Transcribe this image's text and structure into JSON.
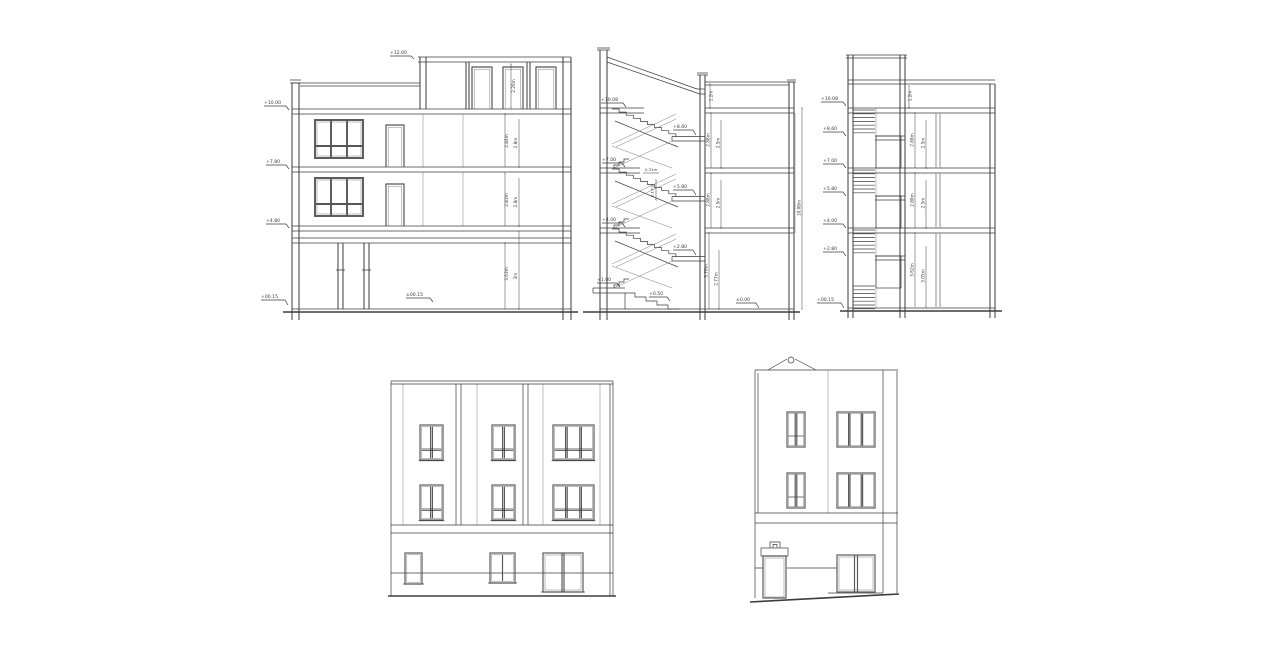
{
  "colors": {
    "line": "#3d3d3d",
    "frame": "#565656",
    "muted": "#9a9a9a",
    "text": "#3a3a3a",
    "background": "#ffffff"
  },
  "sl": {
    "lv_roof_top": "+12.60",
    "lv_roof": "+10.00",
    "lv_f2": "+7.80",
    "lv_f1": "+4.80",
    "lv_gnd": "+00.15",
    "lv_gnd_mid": "±00.15",
    "d_door": "2.20m",
    "d_f2a": "2.84m",
    "d_f2b": "2.8m",
    "d_f1a": "2.83m",
    "d_f1b": "2.8m",
    "d_ga": "3.63m",
    "d_gb": "3m"
  },
  "ss": {
    "lv_roof": "+10.08",
    "lv_l3": "+8.60",
    "lv_f3": "+7.00",
    "lv_l2": "+5.80",
    "lv_f2": "+4.00",
    "lv_l1": "+2.80",
    "lv_f1": "+1.00",
    "lv_entry": "+0.50",
    "lv_gnd": "±0.00",
    "d_par": "1.2m",
    "d_r2a": "2.88m",
    "d_r2b": "2.5m",
    "d_r1a": "2.88m",
    "d_r1b": "2.5m",
    "d_ga": "3.76m",
    "d_gb": "2.77m",
    "d_tot": "10.08m",
    "d_tread": "0.31m",
    "d_riser": "0.17m"
  },
  "sr": {
    "lv_roof": "+10.08",
    "lv_l3": "+8.60",
    "lv_f3": "+7.00",
    "lv_l2": "+5.80",
    "lv_f2": "+4.00",
    "lv_l1": "+2.80",
    "lv_gnd": "+00.15",
    "d_par": "1.2m",
    "d_r2a": "2.88m",
    "d_r2b": "2.5m",
    "d_r1a": "2.88m",
    "d_r1b": "2.5m",
    "d_ga": "3.62m",
    "d_gb": "3.05m"
  }
}
